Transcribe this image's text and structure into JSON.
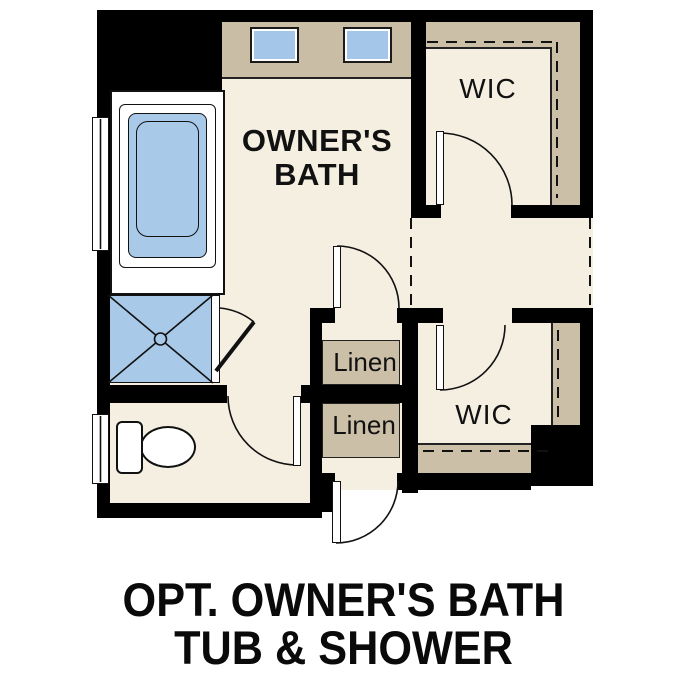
{
  "caption": {
    "line1": "OPT. OWNER'S BATH",
    "line2": "TUB & SHOWER"
  },
  "labels": {
    "owners_bath_line1": "OWNER'S",
    "owners_bath_line2": "BATH",
    "wic_top": "WIC",
    "wic_bottom": "WIC",
    "linen_top": "Linen",
    "linen_bottom": "Linen"
  },
  "colors": {
    "wall": "#000000",
    "floor": "#f5efe2",
    "shelving_tan": "#cbbfa8",
    "vanity_tan": "#c9bda6",
    "fixture_blue": "#a9c9e9",
    "outline": "#111111",
    "background": "#ffffff",
    "text": "#111111"
  },
  "fixtures": [
    "bathtub",
    "shower",
    "toilet",
    "vanity-sink-left",
    "vanity-sink-right",
    "window-upper",
    "window-lower"
  ],
  "doors": [
    "linen-bath-door",
    "toilet-room-door",
    "shower-pivot-door",
    "wic-top-door",
    "wic-bottom-door",
    "entry-door"
  ],
  "closet_rod_style": "dashed"
}
